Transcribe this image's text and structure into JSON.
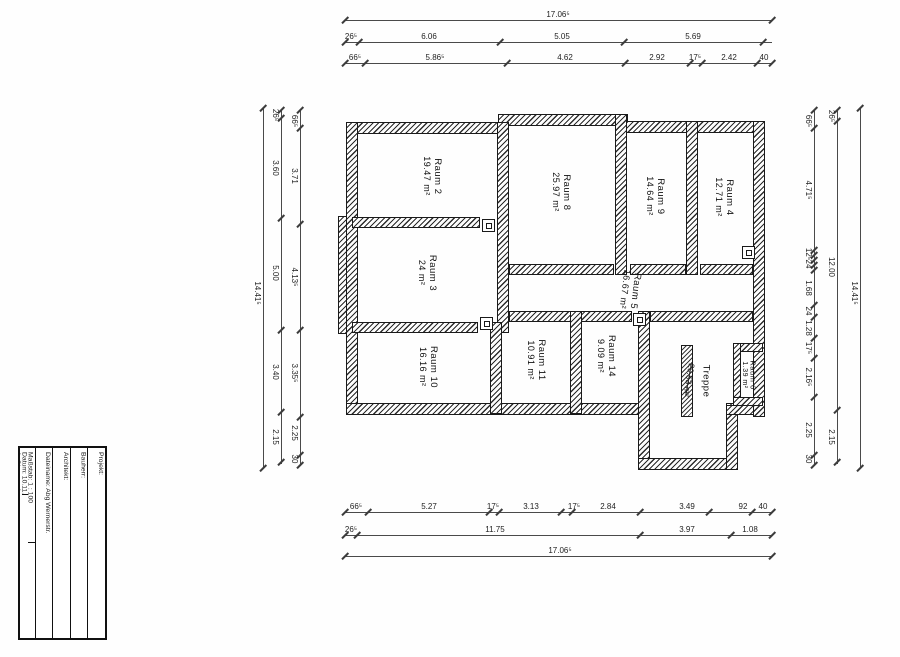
{
  "page": {
    "width": 900,
    "height": 657,
    "background": "#fefefe",
    "ink": "#1c1c1c"
  },
  "title_block": {
    "projekt": "Projekt:",
    "bauherr": "Bauherr:",
    "architekt": "Architekt:",
    "dateiname": "Dateiname: Abg Wernerstr.",
    "massstab": "Maßstab:   1 : 100",
    "datum": "Datum: 10.11.2017",
    "geschoss": "1. Obergeschoss"
  },
  "rooms": [
    {
      "name": "Raum 2",
      "area": "19.47 m²",
      "x": 432,
      "y": 176
    },
    {
      "name": "Raum 8",
      "area": "25.97 m²",
      "x": 561,
      "y": 192
    },
    {
      "name": "Raum 9",
      "area": "14.64 m²",
      "x": 655,
      "y": 196
    },
    {
      "name": "Raum 4",
      "area": "12.71 m²",
      "x": 724,
      "y": 197
    },
    {
      "name": "Raum 3",
      "area": "24 m²",
      "x": 427,
      "y": 273
    },
    {
      "name": "Raum 5",
      "area": "16.67 m²",
      "x": 630,
      "y": 290,
      "rot": 97
    },
    {
      "name": "Raum 10",
      "area": "16.16 m²",
      "x": 428,
      "y": 367
    },
    {
      "name": "Raum 11",
      "area": "10.91 m²",
      "x": 536,
      "y": 360
    },
    {
      "name": "Raum 14",
      "area": "9.09 m²",
      "x": 606,
      "y": 356
    },
    {
      "name": "Treppe",
      "area": "",
      "x": 706,
      "y": 381
    },
    {
      "name": "Raum 6",
      "area": "1.39 m²",
      "x": 748,
      "y": 375,
      "small": true
    }
  ],
  "stair_note": {
    "text": "20.53 m²",
    "x": 689,
    "y": 380,
    "rot": 100
  },
  "walls": [
    {
      "x": 346,
      "y": 122,
      "w": 160,
      "h": 12
    },
    {
      "x": 498,
      "y": 114,
      "w": 130,
      "h": 12
    },
    {
      "x": 622,
      "y": 121,
      "w": 143,
      "h": 12
    },
    {
      "x": 346,
      "y": 122,
      "w": 12,
      "h": 293
    },
    {
      "x": 338,
      "y": 216,
      "w": 9,
      "h": 118
    },
    {
      "x": 346,
      "y": 403,
      "w": 304,
      "h": 12
    },
    {
      "x": 638,
      "y": 311,
      "w": 12,
      "h": 159
    },
    {
      "x": 638,
      "y": 458,
      "w": 100,
      "h": 12
    },
    {
      "x": 726,
      "y": 403,
      "w": 12,
      "h": 67
    },
    {
      "x": 726,
      "y": 405,
      "w": 39,
      "h": 10
    },
    {
      "x": 753,
      "y": 121,
      "w": 12,
      "h": 296
    },
    {
      "x": 497,
      "y": 122,
      "w": 12,
      "h": 211
    },
    {
      "x": 352,
      "y": 217,
      "w": 128,
      "h": 11
    },
    {
      "x": 352,
      "y": 322,
      "w": 126,
      "h": 11
    },
    {
      "x": 509,
      "y": 264,
      "w": 105,
      "h": 11
    },
    {
      "x": 630,
      "y": 264,
      "w": 56,
      "h": 11
    },
    {
      "x": 700,
      "y": 264,
      "w": 53,
      "h": 11
    },
    {
      "x": 509,
      "y": 311,
      "w": 123,
      "h": 11
    },
    {
      "x": 650,
      "y": 311,
      "w": 103,
      "h": 11
    },
    {
      "x": 615,
      "y": 114,
      "w": 12,
      "h": 161
    },
    {
      "x": 686,
      "y": 121,
      "w": 12,
      "h": 154
    },
    {
      "x": 490,
      "y": 322,
      "w": 12,
      "h": 92
    },
    {
      "x": 570,
      "y": 311,
      "w": 12,
      "h": 103
    },
    {
      "x": 733,
      "y": 343,
      "w": 30,
      "h": 9
    },
    {
      "x": 733,
      "y": 343,
      "w": 8,
      "h": 63
    },
    {
      "x": 733,
      "y": 397,
      "w": 30,
      "h": 9
    }
  ],
  "stair_strip": {
    "x": 681,
    "y": 345,
    "w": 12,
    "h": 72
  },
  "doors": [
    {
      "x": 482,
      "y": 219
    },
    {
      "x": 480,
      "y": 317
    },
    {
      "x": 633,
      "y": 313
    },
    {
      "x": 742,
      "y": 246
    }
  ],
  "dimensions": {
    "horizontal": [
      {
        "y": 20,
        "x1": 345,
        "x2": 772,
        "ticks": [
          345,
          772
        ],
        "labels": [
          {
            "t": "17.06⁵",
            "x": 558
          }
        ]
      },
      {
        "y": 42,
        "x1": 345,
        "x2": 772,
        "ticks": [
          345,
          359,
          500,
          624,
          763
        ],
        "labels": [
          {
            "t": "26⁵",
            "x": 351
          },
          {
            "t": "6.06",
            "x": 429
          },
          {
            "t": "5.05",
            "x": 562
          },
          {
            "t": "5.69",
            "x": 693
          }
        ]
      },
      {
        "y": 63,
        "x1": 345,
        "x2": 772,
        "ticks": [
          345,
          365,
          507,
          625,
          690,
          702,
          757,
          772
        ],
        "labels": [
          {
            "t": "66⁵",
            "x": 355
          },
          {
            "t": "5.86⁵",
            "x": 435
          },
          {
            "t": "4.62",
            "x": 565
          },
          {
            "t": "2.92",
            "x": 657
          },
          {
            "t": "17⁵",
            "x": 695
          },
          {
            "t": "2.42",
            "x": 729
          },
          {
            "t": "40",
            "x": 764
          }
        ]
      },
      {
        "y": 512,
        "x1": 345,
        "x2": 772,
        "ticks": [
          345,
          368,
          489,
          499,
          561,
          572,
          640,
          709,
          752,
          772
        ],
        "labels": [
          {
            "t": "66⁵",
            "x": 356
          },
          {
            "t": "5.27",
            "x": 429
          },
          {
            "t": "17⁵",
            "x": 493
          },
          {
            "t": "3.13",
            "x": 531
          },
          {
            "t": "17⁵",
            "x": 574
          },
          {
            "t": "2.84",
            "x": 608
          },
          {
            "t": "3.49",
            "x": 687
          },
          {
            "t": "92",
            "x": 743
          },
          {
            "t": "40",
            "x": 763
          }
        ]
      },
      {
        "y": 535,
        "x1": 345,
        "x2": 772,
        "ticks": [
          345,
          357,
          640,
          731,
          772
        ],
        "labels": [
          {
            "t": "26⁵",
            "x": 351
          },
          {
            "t": "11.75",
            "x": 495
          },
          {
            "t": "3.97",
            "x": 687
          },
          {
            "t": "1.08",
            "x": 750
          }
        ]
      },
      {
        "y": 556,
        "x1": 345,
        "x2": 772,
        "ticks": [
          345,
          772
        ],
        "labels": [
          {
            "t": "17.06⁵",
            "x": 560
          }
        ]
      }
    ],
    "vertical": [
      {
        "x": 263,
        "y1": 108,
        "y2": 468,
        "ticks": [
          108,
          468
        ],
        "labels": [
          {
            "t": "14.41⁵",
            "y": 293
          }
        ]
      },
      {
        "x": 281,
        "y1": 110,
        "y2": 464,
        "ticks": [
          110,
          118,
          218,
          330,
          412,
          462
        ],
        "labels": [
          {
            "t": "26⁵",
            "y": 115
          },
          {
            "t": "3.60",
            "y": 168
          },
          {
            "t": "5.00",
            "y": 273
          },
          {
            "t": "3.40",
            "y": 372
          },
          {
            "t": "2.15",
            "y": 437
          }
        ]
      },
      {
        "x": 300,
        "y1": 110,
        "y2": 466,
        "ticks": [
          110,
          128,
          224,
          330,
          417,
          455,
          465
        ],
        "labels": [
          {
            "t": "66⁵",
            "y": 121
          },
          {
            "t": "3.71",
            "y": 176
          },
          {
            "t": "4.13⁵",
            "y": 277
          },
          {
            "t": "3.35⁵",
            "y": 373
          },
          {
            "t": "2.25",
            "y": 433
          },
          {
            "t": "30",
            "y": 459
          }
        ]
      },
      {
        "x": 814,
        "y1": 110,
        "y2": 466,
        "ticks": [
          110,
          128,
          250,
          255,
          260,
          265,
          270,
          305,
          317,
          338,
          358,
          397,
          455,
          465
        ],
        "labels": [
          {
            "t": "66⁵",
            "y": 121
          },
          {
            "t": "4.71⁵",
            "y": 190
          },
          {
            "t": "12⁵",
            "y": 254
          },
          {
            "t": "24",
            "y": 264
          },
          {
            "t": "1.68",
            "y": 288
          },
          {
            "t": "24",
            "y": 311
          },
          {
            "t": "1.28",
            "y": 328
          },
          {
            "t": "17⁵",
            "y": 348
          },
          {
            "t": "2.16⁵",
            "y": 377
          },
          {
            "t": "2.25",
            "y": 430
          },
          {
            "t": "30",
            "y": 459
          }
        ]
      },
      {
        "x": 837,
        "y1": 110,
        "y2": 464,
        "ticks": [
          110,
          121,
          410,
          462
        ],
        "labels": [
          {
            "t": "26⁵",
            "y": 116
          },
          {
            "t": "12.00",
            "y": 267
          },
          {
            "t": "2.15",
            "y": 437
          }
        ]
      },
      {
        "x": 860,
        "y1": 108,
        "y2": 468,
        "ticks": [
          108,
          468
        ],
        "labels": [
          {
            "t": "14.41⁵",
            "y": 293
          }
        ]
      }
    ]
  }
}
